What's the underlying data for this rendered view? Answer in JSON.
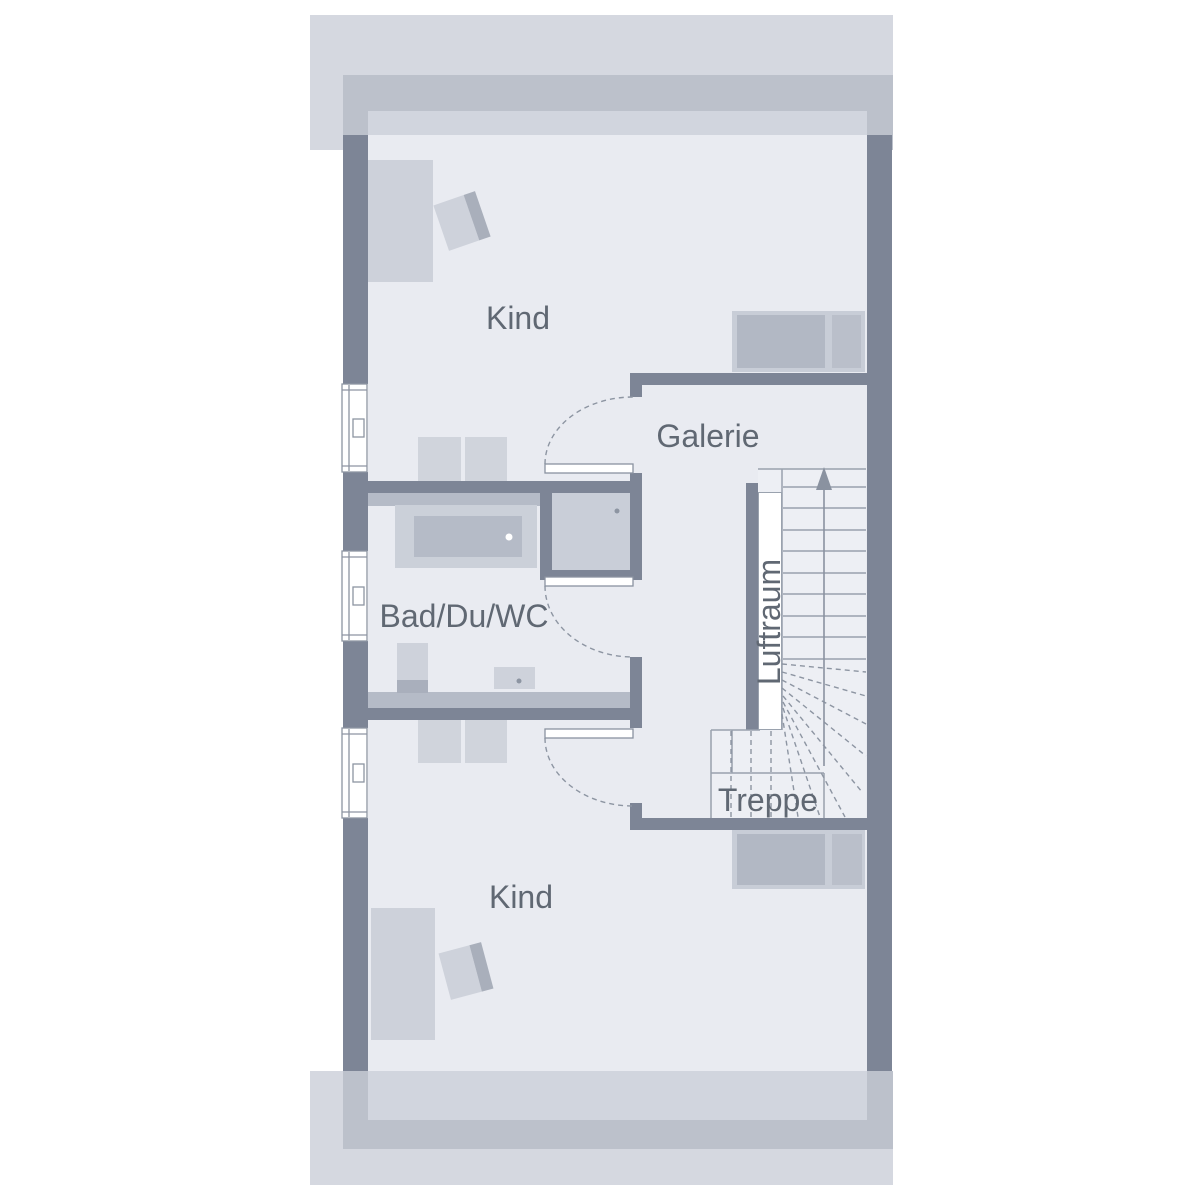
{
  "title": "Grundriss Dachgeschoss",
  "rooms": {
    "kind_top": {
      "label": "Kind"
    },
    "galerie": {
      "label": "Galerie"
    },
    "bad": {
      "label": "Bad/Du/WC"
    },
    "luftraum": {
      "label": "Luftraum"
    },
    "treppe": {
      "label": "Treppe"
    },
    "kind_bottom": {
      "label": "Kind"
    }
  },
  "stairs": {
    "direction": "up",
    "arrow_icon": "arrow-up"
  },
  "colors": {
    "page_bg": "#ffffff",
    "eave": "#d5d8e0",
    "wall_band": "#bcc1cb",
    "wall_band_inner": "#d1d5de",
    "interior": "#e9ebf1",
    "wall": "#7d8596",
    "stair_fill": "#edeff4",
    "line": "#99a1ad",
    "dash_line": "#8d95a2",
    "furniture_light": "#cdd1da",
    "furniture_medium": "#b5bbc7",
    "bed_frame": "#c8cdd7",
    "bed_mattress": "#b2b8c4",
    "bed_pillow": "#babfca",
    "chair_back": "#a9afbb",
    "window_fill": "#ffffff",
    "text": "#606873"
  }
}
